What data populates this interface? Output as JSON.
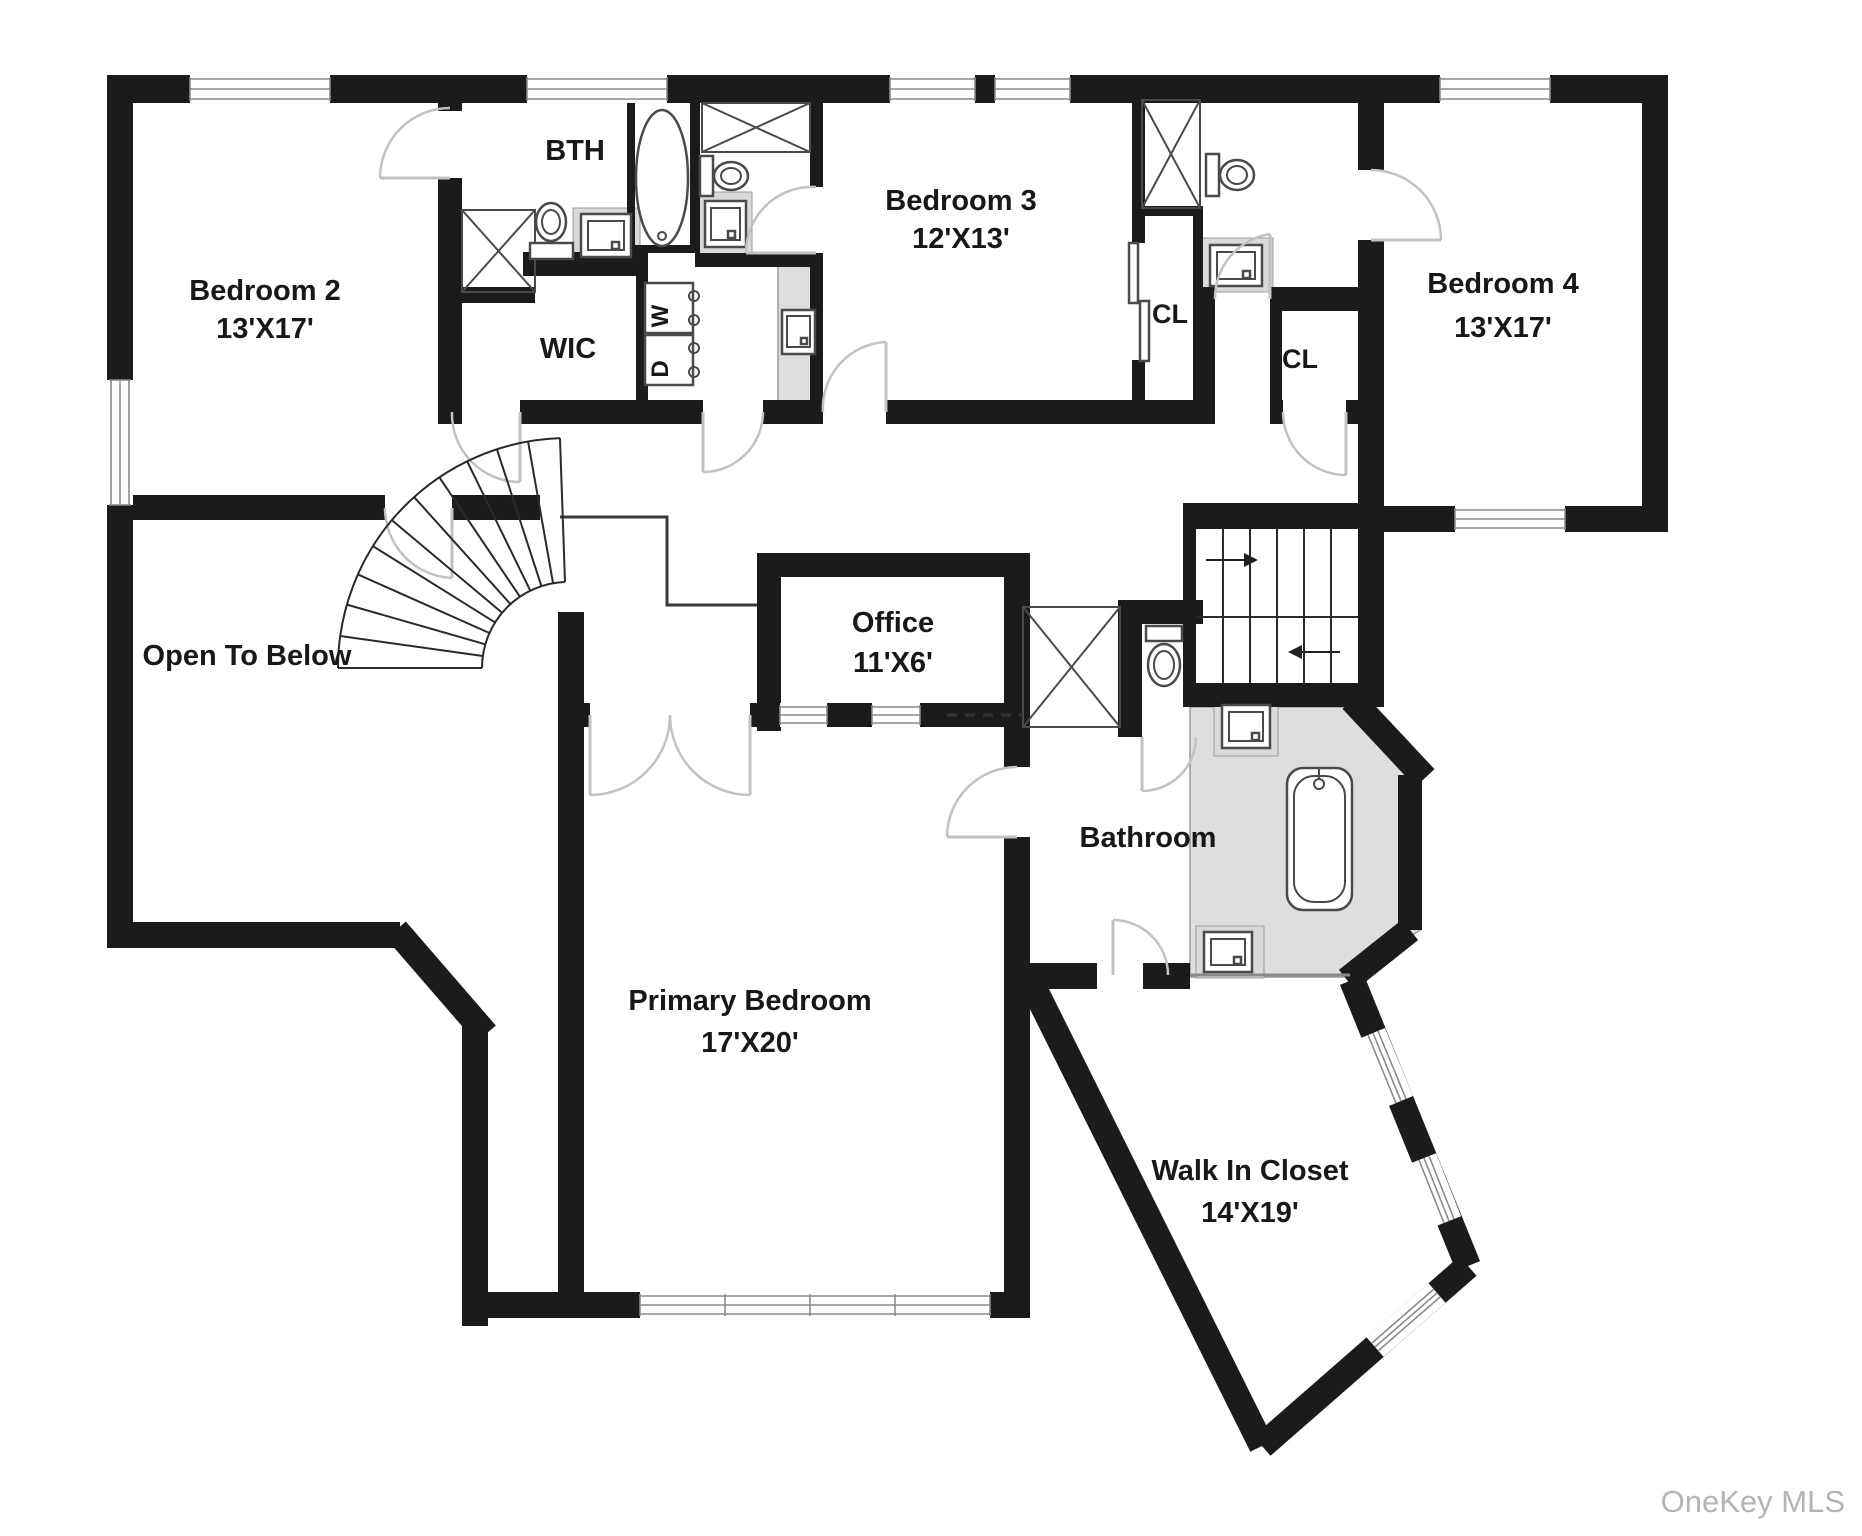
{
  "watermark": "OneKey MLS",
  "rooms": {
    "bedroom2": {
      "name": "Bedroom 2",
      "dims": "13'X17'"
    },
    "bth": {
      "name": "BTH"
    },
    "wic": {
      "name": "WIC"
    },
    "bedroom3": {
      "name": "Bedroom 3",
      "dims": "12'X13'"
    },
    "cl1": {
      "name": "CL"
    },
    "cl2": {
      "name": "CL"
    },
    "bedroom4": {
      "name": "Bedroom 4",
      "dims": "13'X17'"
    },
    "office": {
      "name": "Office",
      "dims": "11'X6'"
    },
    "openbelow": {
      "name": "Open To Below"
    },
    "primary": {
      "name": "Primary Bedroom",
      "dims": "17'X20'"
    },
    "bathroom": {
      "name": "Bathroom"
    },
    "walkin": {
      "name": "Walk In Closet",
      "dims": "14'X19'"
    }
  },
  "laundry": {
    "washer": "W",
    "dryer": "D"
  },
  "colors": {
    "wall": "#1b1b1b",
    "tile": "#dedede",
    "watermark": "#b4b4b4"
  }
}
